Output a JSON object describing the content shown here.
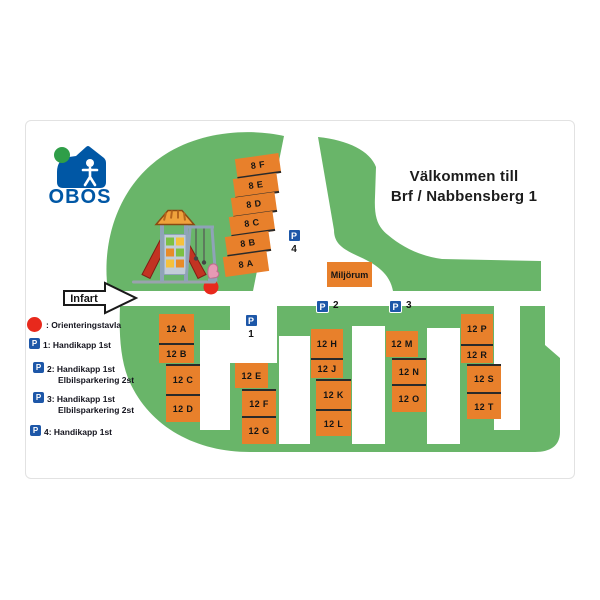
{
  "title": {
    "line1": "Välkommen till",
    "line2": "Brf / Nabbensberg 1"
  },
  "logo": {
    "name": "OBOS"
  },
  "entrance_label": "Infart",
  "waste_room_label": "Miljörum",
  "parking": {
    "p_letter": "P",
    "p1": "1",
    "p2": "2",
    "p3": "3",
    "p4": "4"
  },
  "buildings": {
    "stack8": [
      "8 F",
      "8 E",
      "8 D",
      "8 C",
      "8 B",
      "8 A"
    ],
    "stack12": [
      [
        "12 A",
        "12 B"
      ],
      [
        "12 C",
        "12 D"
      ],
      [
        "12 E"
      ],
      [
        "12 F",
        "12 G"
      ],
      [
        "12 H",
        "12 J"
      ],
      [
        "12 K",
        "12 L"
      ],
      [
        "12 M"
      ],
      [
        "12 N",
        "12 O"
      ],
      [
        "12 P",
        "12 R"
      ],
      [
        "12 S",
        "12 T"
      ]
    ]
  },
  "legend": {
    "board": ": Orienteringstavla",
    "items": [
      {
        "line": "1: Handikapp 1st",
        "line2": ""
      },
      {
        "line": "2: Handikapp 1st",
        "line2": "Elbilsparkering 2st"
      },
      {
        "line": "3: Handikapp 1st",
        "line2": "Elbilsparkering 2st"
      },
      {
        "line": "4: Handikapp 1st",
        "line2": ""
      }
    ]
  },
  "colors": {
    "map_green": "#69b569",
    "building_orange": "#e8802b",
    "parking_blue": "#1d57a8",
    "marker_red": "#e8291c",
    "obos_blue": "#0057a5",
    "obos_green": "#2f9e48"
  }
}
